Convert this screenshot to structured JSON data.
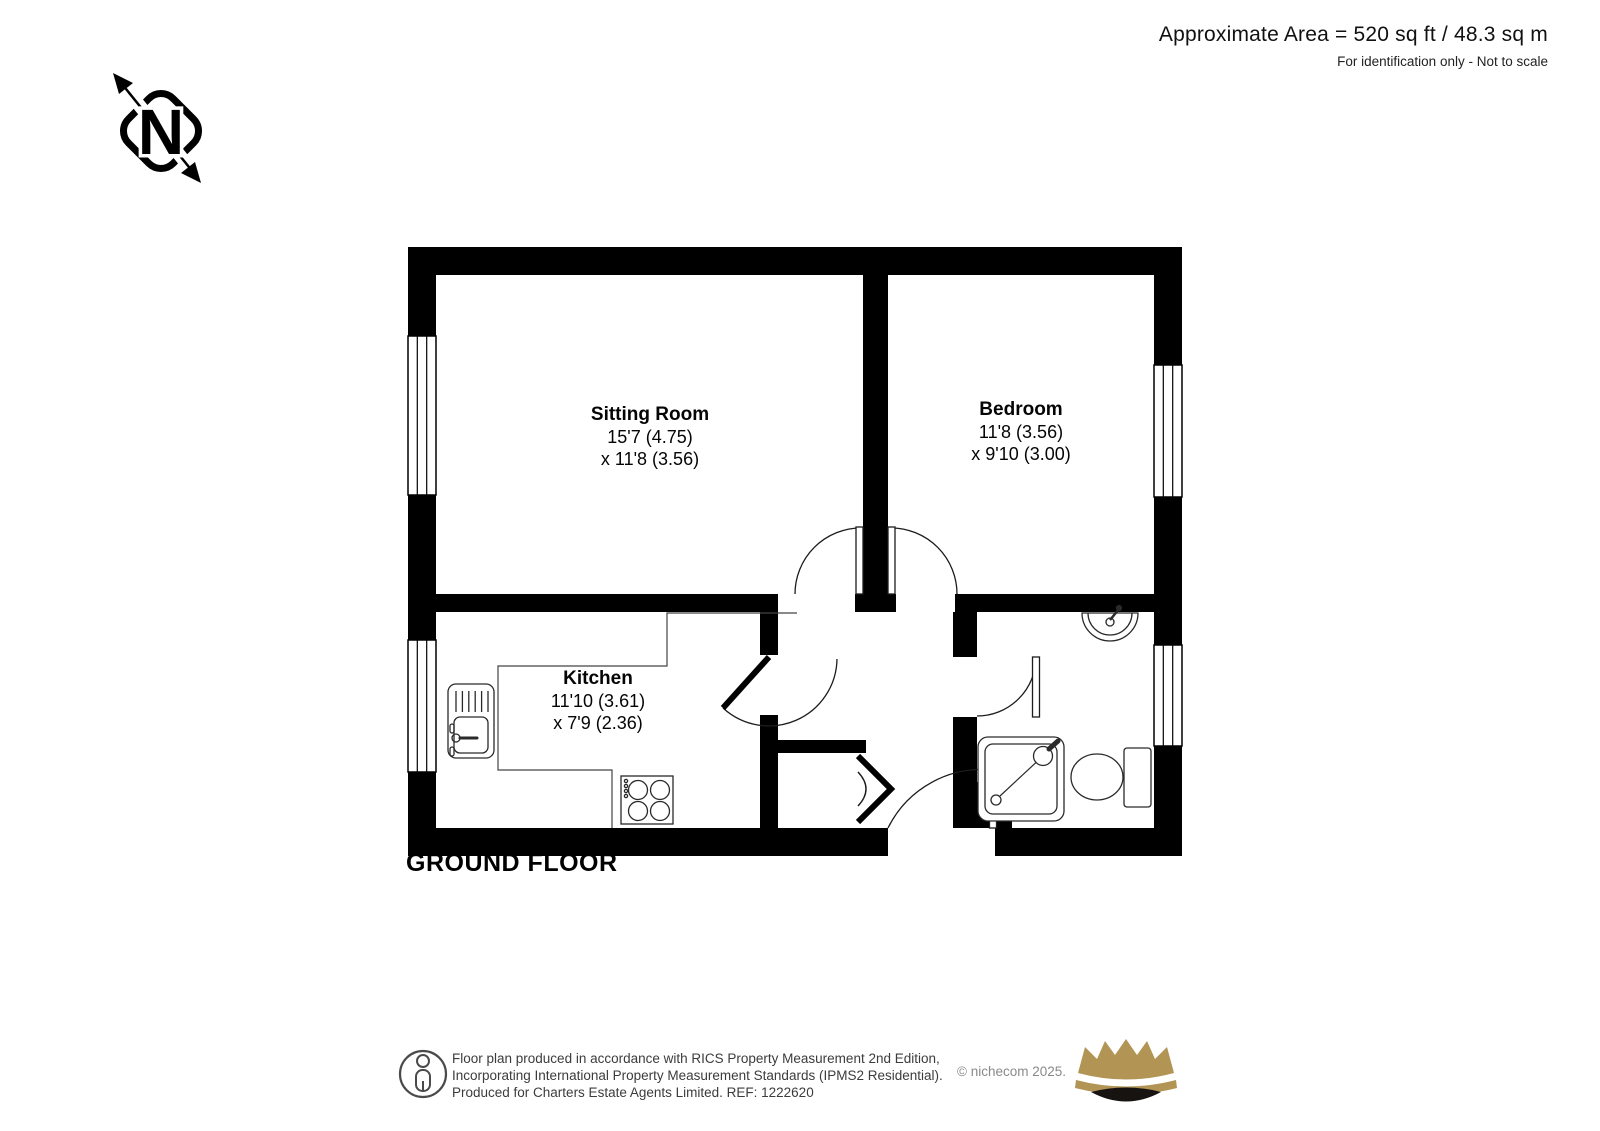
{
  "header": {
    "area": "Approximate Area = 520 sq ft / 48.3 sq m",
    "note": "For identification only - Not to scale"
  },
  "compass": {
    "label": "N"
  },
  "plan": {
    "title": "GROUND FLOOR"
  },
  "rooms": [
    {
      "name": "Sitting Room",
      "dim1": "15'7 (4.75)",
      "dim2": "x 11'8 (3.56)"
    },
    {
      "name": "Bedroom",
      "dim1": "11'8 (3.56)",
      "dim2": "x 9'10 (3.00)"
    },
    {
      "name": "Kitchen",
      "dim1": "11'10 (3.61)",
      "dim2": "x 7'9 (2.36)"
    }
  ],
  "footer": {
    "line1": "Floor plan produced in accordance with RICS Property Measurement 2nd Edition,",
    "line2": "Incorporating International Property Measurement Standards (IPMS2 Residential).",
    "line3": "Produced for Charters Estate Agents Limited.   REF: 1222620",
    "copyright": "© nichecom 2025."
  },
  "colors": {
    "wall": "#000000",
    "crown_gold": "#b29455",
    "crown_base": "#161311",
    "copyright_gray": "#8a8a8a"
  }
}
